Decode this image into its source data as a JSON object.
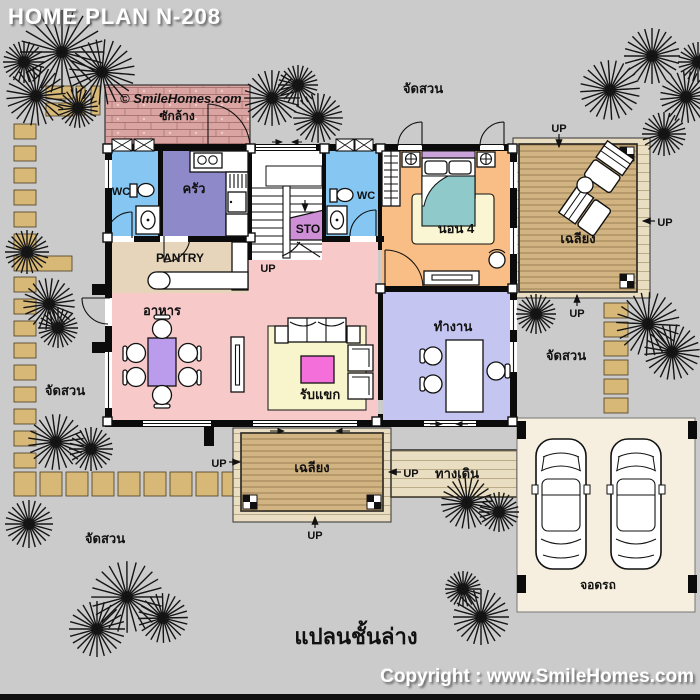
{
  "header": {
    "title": "HOME PLAN N-208"
  },
  "watermark": "© SmileHomes.com",
  "footer": {
    "floor_plan_label": "แปลนชั้นล่าง",
    "copyright": "Copyright : www.SmileHomes.com"
  },
  "rooms": {
    "laundry": "ซักล้าง",
    "wc": "WC",
    "kitchen": "ครัว",
    "storage": "STO",
    "pantry": "PANTRY",
    "bedroom4": "นอน 4",
    "dining": "อาหาร",
    "living": "รับแขก",
    "office": "ทำงาน",
    "porch": "เฉลียง",
    "walkway": "ทางเดิน",
    "parking": "จอดรถ"
  },
  "site": {
    "garden": "จัดสวน",
    "up": "UP"
  },
  "colors": {
    "background": "#cbcbcb",
    "laundry_brick": "#d9a4a2",
    "wc_blue": "#85c6f2",
    "kitchen_purple": "#8e89c8",
    "storage_violet": "#cf8fd6",
    "pantry_tan": "#e6d5ba",
    "living_pink": "#f8c9c9",
    "bedroom_orange": "#f8be85",
    "office_lavender": "#c5c5f2",
    "deck_wood": "#d2b483",
    "walkway_tan": "#e9ddc2",
    "garage_cream": "#f6efdf",
    "paver_tan": "#d7b877",
    "dining_table": "#bb9cec",
    "coffee_table": "#f46fd9",
    "rug_yellow": "#f8f4cc",
    "bedroom_rug": "#faf6d4",
    "bed_teal": "#8fc9c9",
    "headboard_purple": "#c9a3d9",
    "watermark_blue": "#3b50e8"
  }
}
